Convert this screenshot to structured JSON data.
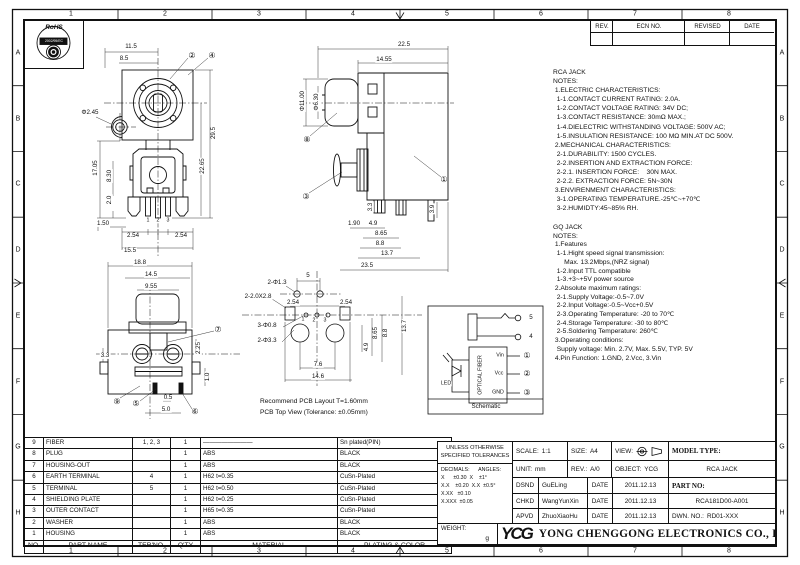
{
  "frame": {
    "cols": [
      "1",
      "2",
      "3",
      "4",
      "5",
      "6",
      "7",
      "8"
    ],
    "rows": [
      "A",
      "B",
      "C",
      "D",
      "E",
      "F",
      "G",
      "H"
    ]
  },
  "rohs": {
    "title": "RoHS",
    "directive": "2002/95/EC"
  },
  "revision_table": {
    "headers": [
      "REV.",
      "ECN NO.",
      "REVISED",
      "DATE"
    ]
  },
  "notes_rca": {
    "lines": [
      "RCA JACK",
      "NOTES:",
      " 1.ELECTRIC CHARACTERISTICS:",
      "  1-1.CONTACT CURRENT RATING: 2.0A.",
      "  1-2.CONTACT VOLTAGE RATING: 34V DC;",
      "  1-3.CONTACT RESISTANCE: 30mΩ MAX.;",
      "  1-4.DIELECTRIC WITHSTANDING VOLTAGE: 500V AC;",
      "  1-5.INSULATION RESISTANCE: 100 MΩ MIN.AT DC 500V.",
      " 2.MECHANICAL CHARACTERISTICS:",
      "  2-1.DURABILITY: 1500 CYCLES.",
      "  2-2.INSERTION AND EXTRACTION FORCE:",
      "  2-2.1. INSERTION FORCE:    30N MAX.",
      "  2-2.2. EXTRACTION FORCE: 5N~30N",
      " 3.ENVIRENMENT CHARACTERISTICS:",
      "  3-1.OPERATING TEMPERATURE.-25℃~+70℃",
      "  3-2.HUMIDTY:45~85% RH."
    ]
  },
  "notes_gq": {
    "lines": [
      "GQ JACK",
      "NOTES:",
      " 1.Features",
      "  1-1.Hight speed signal transmission:",
      "      Max. 13.2Mbps,(NRZ signal)",
      "  1-2.Input TTL compatible",
      "  1-3.+3~+5V power source",
      " 2.Absolute maximum ratings:",
      "  2-1.Supply Voltage:-0.5~7.0V",
      "  2-2.Input Voltage:-0.5~Vcc+0.5V",
      "  2-3.Operating Temperature: -20 to 70℃",
      "  2-4.Storage Temperature: -30 to 80℃",
      "  2-5.Soldering Temperature: 260℃",
      " 3.Operating conditions:",
      "  Supply voltage: Min. 2.7V, Max. 5.5V, TYP. 5V",
      " 4.Pin Function: 1.GND, 2.Vcc, 3.Vin"
    ]
  },
  "views": {
    "front": {
      "dims": [
        {
          "t": "11.5",
          "x": 131,
          "y": 47
        },
        {
          "t": "8.5",
          "x": 124,
          "y": 59
        },
        {
          "t": "Φ2.45",
          "x": 90,
          "y": 113
        },
        {
          "t": "②",
          "x": 192,
          "y": 56
        },
        {
          "t": "④",
          "x": 212,
          "y": 56
        },
        {
          "t": "29.5",
          "x": 214,
          "y": 133,
          "r": 1
        },
        {
          "t": "22.65",
          "x": 203,
          "y": 166,
          "r": 1
        },
        {
          "t": "17.05",
          "x": 96,
          "y": 168,
          "r": 1
        },
        {
          "t": "8.30",
          "x": 110,
          "y": 176,
          "r": 1
        },
        {
          "t": "2.0",
          "x": 110,
          "y": 200,
          "r": 1
        },
        {
          "t": "1.50",
          "x": 103,
          "y": 224
        },
        {
          "t": "1",
          "x": 148,
          "y": 221,
          "s": 1
        },
        {
          "t": "2",
          "x": 158,
          "y": 221,
          "s": 1
        },
        {
          "t": "3",
          "x": 168,
          "y": 221,
          "s": 1
        },
        {
          "t": "2.54",
          "x": 133,
          "y": 236
        },
        {
          "t": "2.54",
          "x": 181,
          "y": 236
        },
        {
          "t": "15.5",
          "x": 130,
          "y": 251
        }
      ]
    },
    "side": {
      "dims": [
        {
          "t": "22.5",
          "x": 404,
          "y": 45
        },
        {
          "t": "14.55",
          "x": 384,
          "y": 60
        },
        {
          "t": "Φ11.00",
          "x": 303,
          "y": 101,
          "r": 1
        },
        {
          "t": "Φ6.30",
          "x": 317,
          "y": 102,
          "r": 1
        },
        {
          "t": "⑧",
          "x": 307,
          "y": 140
        },
        {
          "t": "③",
          "x": 306,
          "y": 197
        },
        {
          "t": "①",
          "x": 444,
          "y": 180
        },
        {
          "t": "3.3",
          "x": 371,
          "y": 207,
          "r": 1
        },
        {
          "t": "3.9",
          "x": 433,
          "y": 209,
          "r": 1
        },
        {
          "t": "1.90",
          "x": 354,
          "y": 224
        },
        {
          "t": "4.9",
          "x": 373,
          "y": 224
        },
        {
          "t": "8.65",
          "x": 381,
          "y": 234
        },
        {
          "t": "8.8",
          "x": 380,
          "y": 244
        },
        {
          "t": "13.7",
          "x": 387,
          "y": 254
        },
        {
          "t": "23.5",
          "x": 367,
          "y": 266
        }
      ]
    },
    "bottom": {
      "dims": [
        {
          "t": "18.8",
          "x": 140,
          "y": 263
        },
        {
          "t": "14.5",
          "x": 151,
          "y": 275
        },
        {
          "t": "9.55",
          "x": 151,
          "y": 287
        },
        {
          "t": "⑦",
          "x": 218,
          "y": 330
        },
        {
          "t": "3.3",
          "x": 105,
          "y": 356
        },
        {
          "t": "2.25",
          "x": 199,
          "y": 348,
          "r": 1
        },
        {
          "t": "1.0",
          "x": 208,
          "y": 377,
          "r": 1
        },
        {
          "t": "0.5",
          "x": 168,
          "y": 398
        },
        {
          "t": "5.0",
          "x": 166,
          "y": 410
        },
        {
          "t": "⑨",
          "x": 117,
          "y": 402
        },
        {
          "t": "⑤",
          "x": 136,
          "y": 404
        },
        {
          "t": "⑥",
          "x": 195,
          "y": 412
        }
      ]
    },
    "pcb": {
      "dims": [
        {
          "t": "2-Φ1.3",
          "x": 277,
          "y": 283
        },
        {
          "t": "5",
          "x": 308,
          "y": 276
        },
        {
          "t": "2-2.0X2.8",
          "x": 258,
          "y": 297
        },
        {
          "t": "2.54",
          "x": 293,
          "y": 303
        },
        {
          "t": "2.54",
          "x": 346,
          "y": 303
        },
        {
          "t": "3-Φ0.8",
          "x": 267,
          "y": 326
        },
        {
          "t": "2-Φ3.3",
          "x": 267,
          "y": 341
        },
        {
          "t": "1",
          "x": 303,
          "y": 320,
          "s": 1
        },
        {
          "t": "2",
          "x": 314,
          "y": 321,
          "s": 1
        },
        {
          "t": "3",
          "x": 325,
          "y": 321,
          "s": 1
        },
        {
          "t": "4.9",
          "x": 367,
          "y": 347,
          "r": 1
        },
        {
          "t": "8.65",
          "x": 376,
          "y": 333,
          "r": 1
        },
        {
          "t": "8.8",
          "x": 386,
          "y": 333,
          "r": 1
        },
        {
          "t": "13.7",
          "x": 405,
          "y": 326,
          "r": 1
        },
        {
          "t": "7.6",
          "x": 318,
          "y": 365
        },
        {
          "t": "14.6",
          "x": 318,
          "y": 377
        }
      ],
      "caption1": "Recommend PCB Layout T=1.60mm",
      "caption2": "PCB Top View (Tolerance: ±0.05mm)"
    },
    "schematic": {
      "dims": [
        {
          "t": "5",
          "x": 531,
          "y": 318
        },
        {
          "t": "4",
          "x": 531,
          "y": 337
        },
        {
          "t": "Vin",
          "x": 500,
          "y": 356,
          "s": 1
        },
        {
          "t": "Vcc",
          "x": 499,
          "y": 374,
          "s": 1
        },
        {
          "t": "GND",
          "x": 498,
          "y": 393,
          "s": 1
        },
        {
          "t": "①",
          "x": 527,
          "y": 356
        },
        {
          "t": "②",
          "x": 527,
          "y": 374
        },
        {
          "t": "③",
          "x": 527,
          "y": 393
        },
        {
          "t": "LED",
          "x": 446,
          "y": 384,
          "s": 1
        },
        {
          "t": "OPTICAL FIBER",
          "x": 481,
          "y": 375,
          "r": 1,
          "s": 1
        },
        {
          "t": "Schematic",
          "x": 486,
          "y": 407
        }
      ]
    }
  },
  "parts_table": {
    "headers": [
      "NO.",
      "PART NAME",
      "TER'NO.",
      "Q'TY",
      "MATERIAL",
      "PLATING & COLOR"
    ],
    "rows": [
      [
        "9",
        "FIBER",
        "1, 2, 3",
        "1",
        "————————",
        "Sn plated(PIN)"
      ],
      [
        "8",
        "PLUG",
        "",
        "1",
        "ABS",
        "BLACK"
      ],
      [
        "7",
        "HOUSING-OUT",
        "",
        "1",
        "ABS",
        "BLACK"
      ],
      [
        "6",
        "EARTH TERMINAL",
        "4",
        "1",
        "H62  t=0.35",
        "CuSn-Plated"
      ],
      [
        "5",
        "TERMINAL",
        "5",
        "1",
        "H62  t=0.50",
        "CuSn-Plated"
      ],
      [
        "4",
        "SHIELDING PLATE",
        "",
        "1",
        "H62  t=0.25",
        "CuSn-Plated"
      ],
      [
        "3",
        "OUTER CONTACT",
        "",
        "1",
        "H65  t=0.35",
        "CuSn-Plated"
      ],
      [
        "2",
        "WASHER",
        "",
        "1",
        "ABS",
        "BLACK"
      ],
      [
        "1",
        "HOUSING",
        "",
        "1",
        "ABS",
        "BLACK"
      ]
    ]
  },
  "title_block": {
    "tolerances": {
      "title1": "UNLESS OTHERWISE",
      "title2": "SPECIFIED TOLERANCES",
      "lines": [
        "DECIMALS:      ANGLES:",
        "X      ±0.30  X    ±1°",
        "X.X    ±0.20  X.X  ±0.5°",
        "X.XX   ±0.10",
        "X.XXX  ±0.05"
      ]
    },
    "scale_label": "SCALE:",
    "scale_value": "1:1",
    "size_label": "SIZE:",
    "size_value": "A4",
    "view_label": "VIEW:",
    "unit_label": "UNIT:",
    "unit_value": "mm",
    "rev_label": "REV.:",
    "rev_value": "A/0",
    "object_label": "OBJECT:",
    "object_value": "YCG",
    "model_label": "MODEL TYPE:",
    "model_value": "RCA JACK",
    "part_label": "PART NO:",
    "part_value": "RCA181D00-A001",
    "dwn_label": "DWN. NO.:",
    "dwn_value": "RD01-XXX",
    "date_label": "DATE",
    "signoff": [
      {
        "role": "DSND",
        "name": "GuELing",
        "date": "2011.12.13"
      },
      {
        "role": "CHKD",
        "name": "WangYunXin",
        "date": "2011.12.13"
      },
      {
        "role": "APVD",
        "name": "ZhuoXiaoHu",
        "date": "2011.12.13"
      }
    ],
    "weight_label": "WEIGHT:",
    "weight_unit": "g"
  },
  "company": {
    "logo": "YCG",
    "name": "YONG CHENGGONG ELECTRONICS CO., LTD."
  }
}
